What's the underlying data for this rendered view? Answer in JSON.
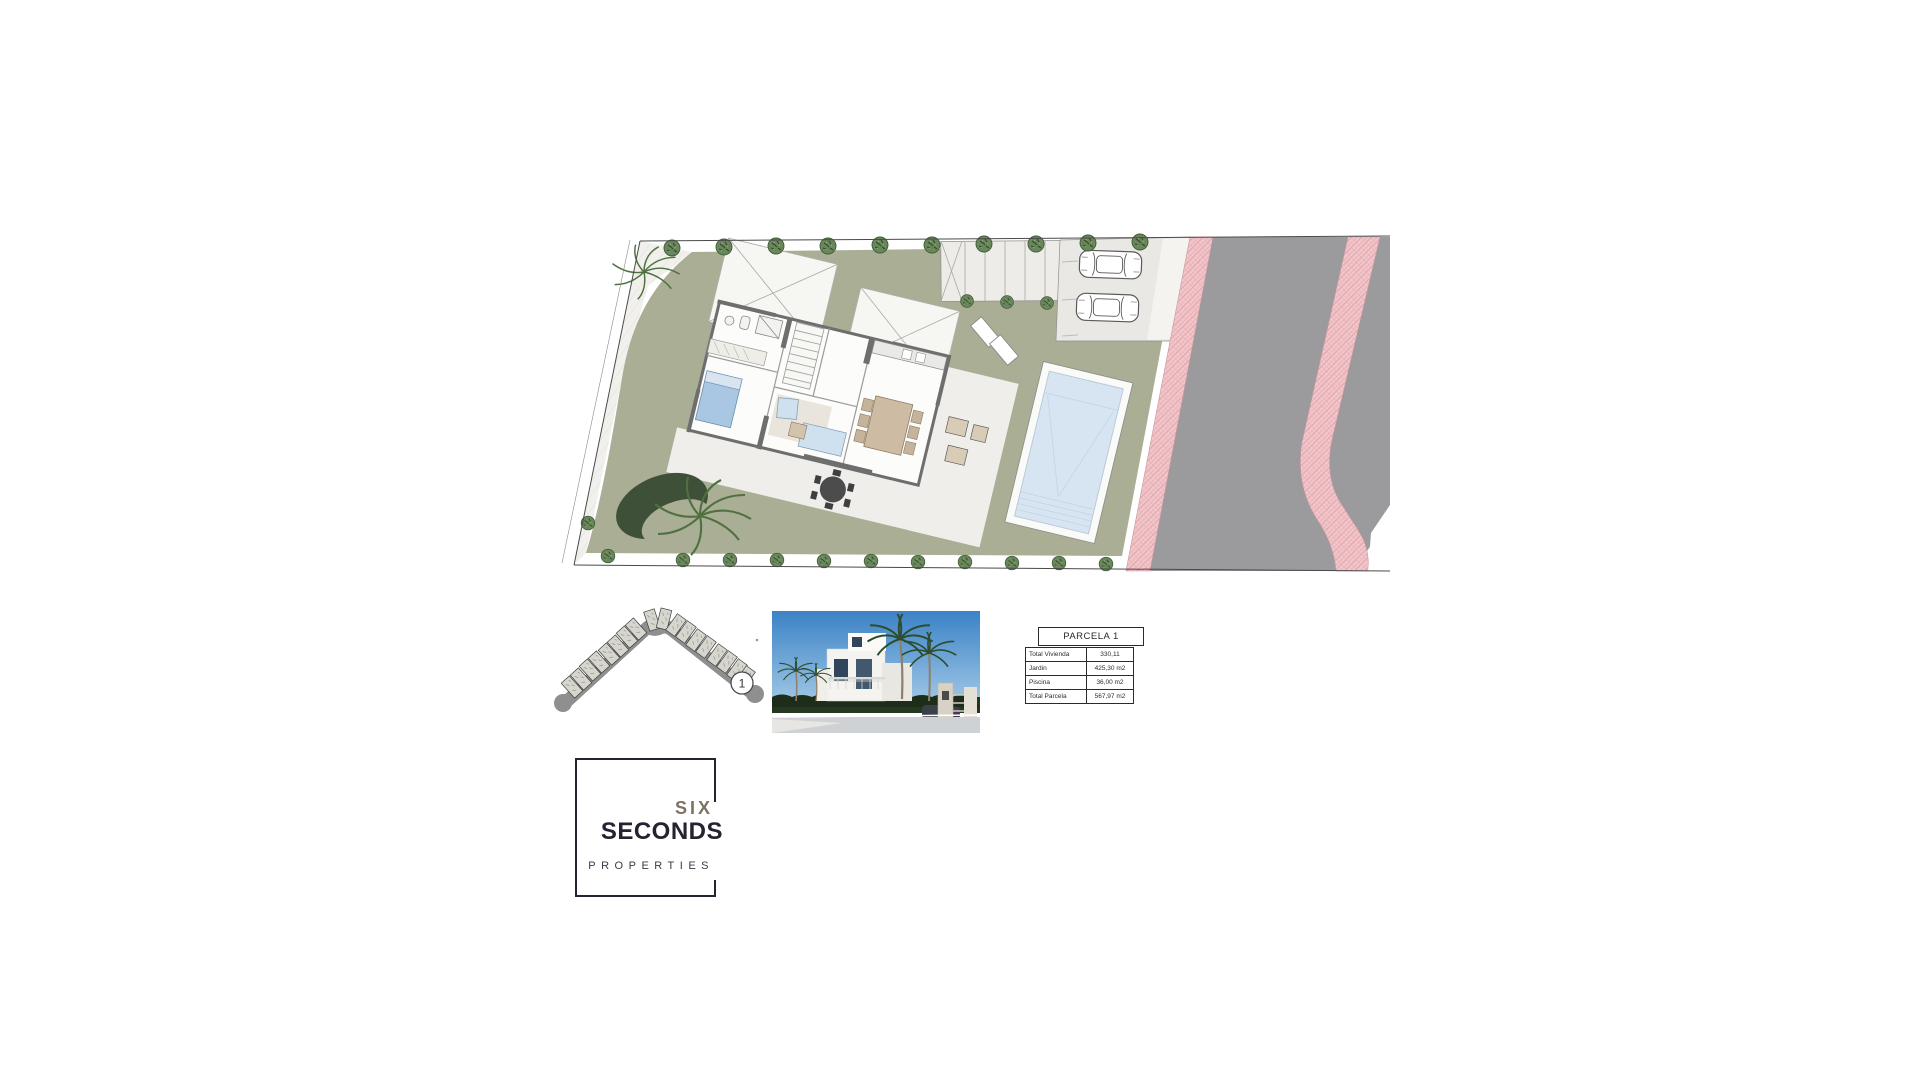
{
  "site_plan": {
    "description": "Tilted site plan of a single villa parcel with garden, swimming pool, terrace, pergola, parking with two cars, and a road with pink cross-hatched sidewalks on the right",
    "colors": {
      "garden": "#a9ae94",
      "terrace": "#efeeea",
      "pool_water": "#d7e5f2",
      "parking": "#e9e8e4",
      "road": "#9b9b9d",
      "sidewalk_pink": "#f2c6ca",
      "sidewalk_hatch": "#dfa3ab",
      "walls": "#6e6e6e",
      "trees": "#69875a"
    }
  },
  "key_map": {
    "parcel_badge": "1"
  },
  "table": {
    "title": "PARCELA 1",
    "rows": [
      {
        "label": "Total Vivienda",
        "value": "330,11"
      },
      {
        "label": "Jardin",
        "value": "425,30 m2"
      },
      {
        "label": "Piscina",
        "value": "36,00 m2"
      },
      {
        "label": "Total Parcela",
        "value": "567,97 m2"
      }
    ]
  },
  "logo": {
    "word1": "SIX",
    "word2": "SECONDS",
    "word3": "PROPERTIES",
    "color_word1": "#7d7264",
    "color_word2": "#262230",
    "color_word3": "#3c3947"
  }
}
